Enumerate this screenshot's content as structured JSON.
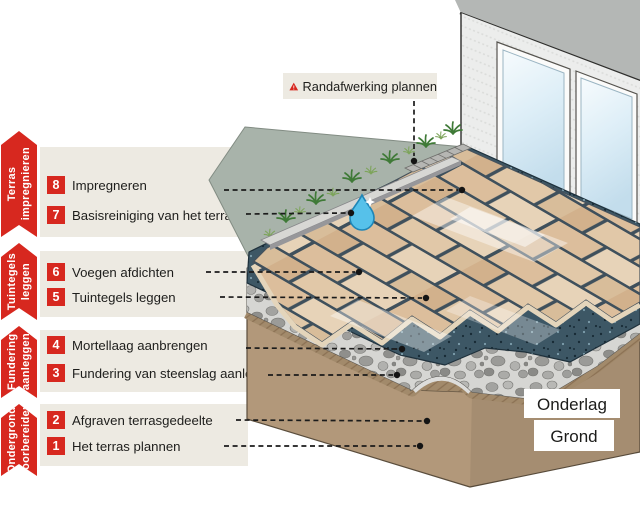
{
  "ribbons": [
    {
      "label": "Terras\nimpregnieren"
    },
    {
      "label": "Tuintegels\nleggen"
    },
    {
      "label": "Fundering\naanleggen"
    },
    {
      "label": "Ondergrond\nvoorbereiden"
    }
  ],
  "callout": {
    "label": "Randafwerking plannen",
    "icon": "warning-icon",
    "icon_glyph": "!"
  },
  "steps": [
    {
      "num": "8",
      "label": "Impregneren"
    },
    {
      "num": "7",
      "label": "Basisreiniging van het terras"
    },
    {
      "num": "6",
      "label": "Voegen afdichten"
    },
    {
      "num": "5",
      "label": "Tuintegels leggen"
    },
    {
      "num": "4",
      "label": "Mortellaag aanbrengen"
    },
    {
      "num": "3",
      "label": "Fundering van steenslag aanleggen"
    },
    {
      "num": "2",
      "label": "Afgraven terrasgedeelte"
    },
    {
      "num": "1",
      "label": "Het terras plannen"
    }
  ],
  "scene_labels": {
    "onderlag": "Onderlag",
    "grond": "Grond"
  },
  "icons": [
    "warning-icon",
    "water-drop-icon",
    "grass-tuft-icon"
  ],
  "colors": {
    "accent_red": "#d7281f",
    "box_beige": "#edeae2",
    "grout": "#3f505c",
    "tile": "#dcbe9c",
    "mortar": "#3d5765",
    "gravel": "#d6d6d3",
    "ground": "#b2987a",
    "grass": "#a8b3aa",
    "water": "#56c1ea"
  }
}
